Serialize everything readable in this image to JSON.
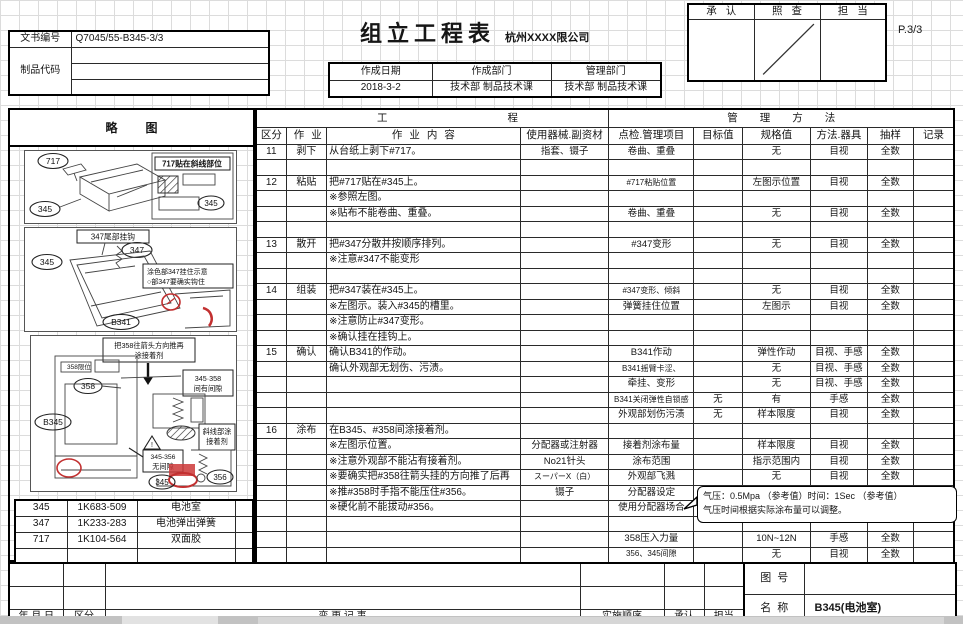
{
  "header": {
    "doc_no_label": "文书编号",
    "doc_no": "Q7045/55-B345-3/3",
    "product_code_label": "制品代码",
    "title": "组立工程表",
    "company": "杭州XXXX限公司",
    "page": "P.3/3",
    "date_label": "作成日期",
    "date": "2018-3-2",
    "dept_label": "作成部门",
    "dept": "技术部  制品技术课",
    "mgmt_label": "管理部门",
    "mgmt": "技术部  制品技术课",
    "approve": "承认",
    "check": "照查",
    "charge": "担当"
  },
  "table": {
    "sketch_header": "略图",
    "process_header": "工程",
    "mgmt_header": "管理方法",
    "columns": [
      "区分",
      "作业",
      "作业内容",
      "使用器械.副资材",
      "点检.管理项目",
      "目标值",
      "规格值",
      "方法.器具",
      "抽样",
      "记录"
    ],
    "rows": [
      [
        "11",
        "剥下",
        "从台纸上剥下#717。",
        "指套、镊子",
        "卷曲、重叠",
        "",
        "无",
        "目视",
        "全数",
        ""
      ],
      [
        "",
        "",
        "",
        "",
        "",
        "",
        "",
        "",
        "",
        ""
      ],
      [
        "12",
        "粘贴",
        "把#717贴在#345上。",
        "",
        "#717粘贴位置",
        "",
        "左图示位置",
        "目视",
        "全数",
        ""
      ],
      [
        "",
        "",
        "※参照左图。",
        "",
        "",
        "",
        "",
        "",
        "",
        ""
      ],
      [
        "",
        "",
        "※贴布不能卷曲、重叠。",
        "",
        "卷曲、重叠",
        "",
        "无",
        "目视",
        "全数",
        ""
      ],
      [
        "",
        "",
        "",
        "",
        "",
        "",
        "",
        "",
        "",
        ""
      ],
      [
        "13",
        "散开",
        "把#347分散并按顺序排列。",
        "",
        "#347变形",
        "",
        "无",
        "目视",
        "全数",
        ""
      ],
      [
        "",
        "",
        "※注意#347不能变形",
        "",
        "",
        "",
        "",
        "",
        "",
        ""
      ],
      [
        "",
        "",
        "",
        "",
        "",
        "",
        "",
        "",
        "",
        ""
      ],
      [
        "14",
        "组装",
        "把#347装在#345上。",
        "",
        "#347变形、倾斜",
        "",
        "无",
        "目视",
        "全数",
        ""
      ],
      [
        "",
        "",
        "※左图示。装入#345的槽里。",
        "",
        "弹簧挂住位置",
        "",
        "左图示",
        "目视",
        "全数",
        ""
      ],
      [
        "",
        "",
        "※注意防止#347变形。",
        "",
        "",
        "",
        "",
        "",
        "",
        ""
      ],
      [
        "",
        "",
        "※确认挂在挂钩上。",
        "",
        "",
        "",
        "",
        "",
        "",
        ""
      ],
      [
        "15",
        "确认",
        "确认B341的作动。",
        "",
        "B341作动",
        "",
        "弹性作动",
        "目视、手感",
        "全数",
        ""
      ],
      [
        "",
        "",
        "确认外观部无划伤、污渍。",
        "",
        "B341摇臂卡涩、",
        "",
        "无",
        "目视、手感",
        "全数",
        ""
      ],
      [
        "",
        "",
        "",
        "",
        "牵挂、变形",
        "",
        "无",
        "目视、手感",
        "全数",
        ""
      ],
      [
        "",
        "",
        "",
        "",
        "B341关闭弹性自锁感",
        "无",
        "有",
        "手感",
        "全数",
        ""
      ],
      [
        "",
        "",
        "",
        "",
        "外观部划伤污渍",
        "无",
        "样本限度",
        "目视",
        "全数",
        ""
      ],
      [
        "16",
        "涂布",
        "在B345、#358间涂接着剂。",
        "",
        "",
        "",
        "",
        "",
        "",
        ""
      ],
      [
        "",
        "",
        "※左图示位置。",
        "分配器或注射器",
        "接着剂涂布量",
        "",
        "样本限度",
        "目视",
        "全数",
        ""
      ],
      [
        "",
        "",
        "※注意外观部不能沾有接着剂。",
        "No21针头",
        "涂布范围",
        "",
        "指示范围内",
        "目视",
        "全数",
        ""
      ],
      [
        "",
        "",
        "※要确实把#358往箭头挂的方向推了后再",
        "スーパーX（白）",
        "外观部飞溅",
        "",
        "无",
        "目视",
        "全数",
        ""
      ],
      [
        "",
        "",
        "※推#358时手指不能压住#356。",
        "镊子",
        "分配器设定",
        "",
        "",
        "",
        "",
        ""
      ],
      [
        "",
        "",
        "※硬化前不能拔动#356。",
        "",
        "使用分配器场合",
        "",
        "",
        "",
        "",
        ""
      ],
      [
        "",
        "",
        "",
        "",
        "",
        "",
        "",
        "",
        "",
        ""
      ],
      [
        "",
        "",
        "",
        "",
        "358压入力量",
        "",
        "10N~12N",
        "手感",
        "全数",
        ""
      ],
      [
        "",
        "",
        "",
        "",
        "356、345间隙",
        "",
        "无",
        "目视",
        "全数",
        ""
      ]
    ]
  },
  "callout": {
    "line1": "气压：0.5Mpa （参考值）时间：1Sec （参考值）",
    "line2": "气压时间根据实际涂布量可以调整。"
  },
  "sketches": {
    "box1": {
      "part_top": "717",
      "part_left": "345",
      "caption": "717贴在斜线部位",
      "part_inset": "345"
    },
    "box2": {
      "tag": "347尾部挂钩",
      "part_left": "345",
      "part_spring": "347",
      "caption1": "涂色部347挂住示意",
      "caption2": "○部347要确实钩住",
      "part_bottom": "B341"
    },
    "box3": {
      "caption_top1": "把358往箭头方向推再",
      "caption_top2": "涂接着剂",
      "limit_note": "358限位",
      "part_358": "358",
      "gap1": "345·358",
      "gap2": "间有间隙",
      "part_b345": "B345",
      "glue1": "斜线部涂",
      "glue2": "接着剂",
      "nogap1": "345-356",
      "nogap2": "无间隙",
      "part_345": "345",
      "part_356": "356"
    }
  },
  "parts": [
    [
      "345",
      "1K683-509",
      "电池室",
      ""
    ],
    [
      "347",
      "1K233-283",
      "电池弹出弹簧",
      ""
    ],
    [
      "717",
      "1K104-564",
      "双面胶",
      ""
    ],
    [
      "",
      "",
      "",
      ""
    ]
  ],
  "footer": {
    "rev_rows": [
      [
        "",
        "",
        "",
        "",
        "",
        ""
      ],
      [
        "",
        "",
        "",
        "",
        "",
        ""
      ]
    ],
    "date_label": "年 月 日",
    "category_label": "区分",
    "change_label": "变  更  记  事",
    "impl_label": "实施顺序",
    "approve_label": "承认",
    "charge_label": "担当",
    "drawing_no_label": "图号",
    "drawing_no_value": "",
    "name_label": "名称",
    "product_name": "B345(电池室)"
  }
}
